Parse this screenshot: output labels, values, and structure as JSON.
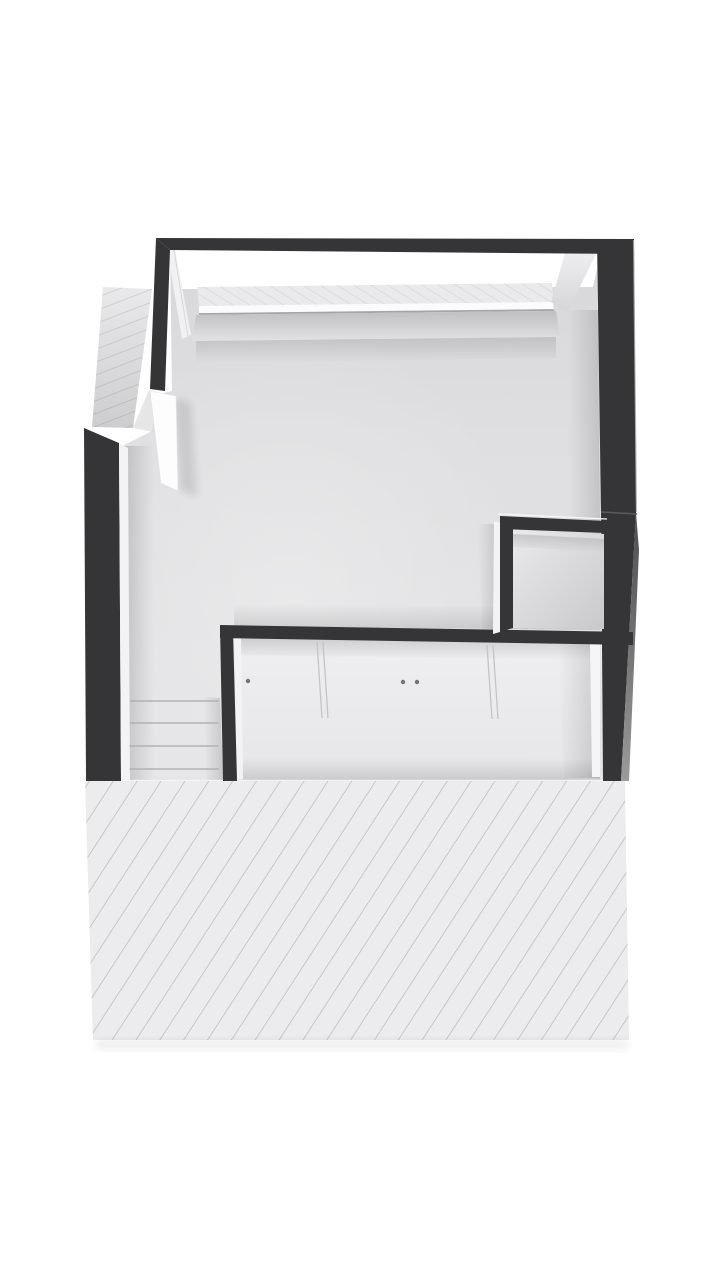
{
  "scene": {
    "kind": "3d-floorplan-top-down-view",
    "description": "Attic level dollhouse floor plan seen from above on a white background",
    "regions": [
      {
        "name": "main-room-floor",
        "kind": "open room floor, light grey"
      },
      {
        "name": "wardrobe-closet",
        "kind": "built-in wardrobe with sliding door seams and knobs"
      },
      {
        "name": "small-closet-room",
        "kind": "small walled storage room, middle right"
      },
      {
        "name": "staircase",
        "kind": "stair treads at lower left"
      },
      {
        "name": "lower-sloped-roof",
        "kind": "large diagonally hatched roof surface at bottom"
      },
      {
        "name": "upper-left-sloped-roof",
        "kind": "small diagonally hatched roof surface at upper left"
      },
      {
        "name": "top-roof-strip",
        "kind": "narrow hatched strip behind the top wall"
      }
    ],
    "staircase": {
      "tread_lines": 4
    },
    "wardrobe": {
      "knobs": 3,
      "door_seam_pairs": 2
    }
  },
  "colors": {
    "background": "#ffffff",
    "wall_dark": "#353538",
    "wall_seam": "#5a5a5d",
    "wall_outer_light": "#aaaaad",
    "floor_light": "#e4e4e6",
    "knee_wall_edge": "#a4a4a6",
    "hatch_bg": "#ececee",
    "hatch_line": "#c2c2c4",
    "hatch_line_small": "#c8c8ca",
    "hatch_line_top": "#d3d3d5",
    "white_trim": "#f3f3f5",
    "white_wedge": "#fdfdfd",
    "closet_panel_trim": "#f5f5f7",
    "door_seam": "#c4c4c6",
    "knob": "#737376",
    "stair_line": "#b2b2b4"
  }
}
